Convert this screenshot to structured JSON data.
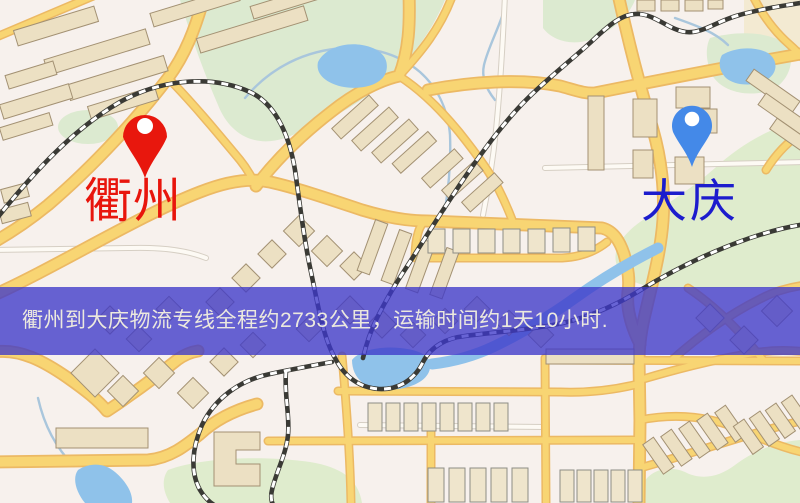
{
  "map": {
    "origin": {
      "name": "衢州",
      "pin_color": "#e8170d",
      "label_color": "#e8150c"
    },
    "destination": {
      "name": "大庆",
      "pin_color": "#4489e8",
      "label_color": "#1c1ccd"
    },
    "banner": {
      "text": "衢州到大庆物流专线全程约2733公里，运输时间约1天10小时.",
      "bg_color": "#3d39c9",
      "text_color": "#ece9de"
    },
    "palette": {
      "map_background": "#f7f1ed",
      "road_yellow": "#f8d573",
      "road_casing": "#ecb964",
      "park_green": "#dcead0",
      "water_blue": "#8fc2ea",
      "building_fill": "#ece0c3",
      "railway_dark": "#3a3a35"
    }
  }
}
